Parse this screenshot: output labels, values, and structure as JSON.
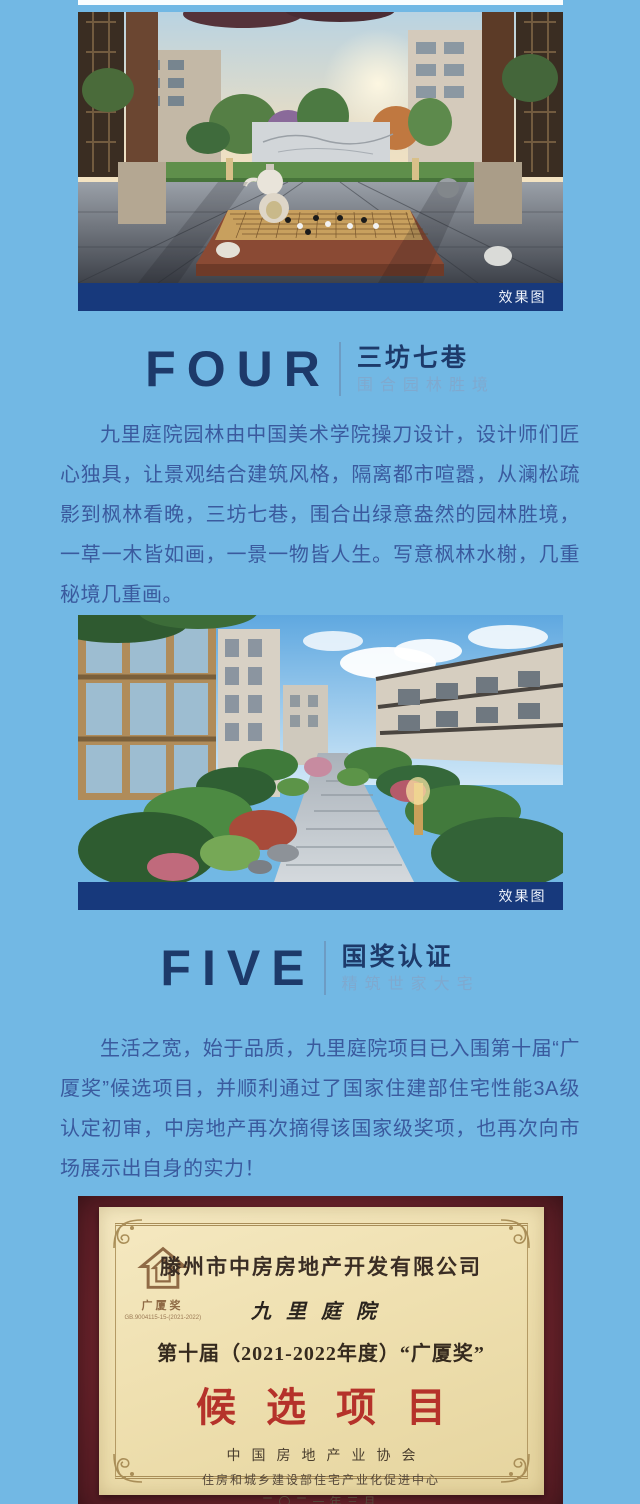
{
  "colors": {
    "background": "#72b8e4",
    "caption_bar": "#17397c",
    "heading_navy": "#1d3a6a",
    "paragraph_blue": "#3a5a9e",
    "subtitle_blue": "#7fa9cf",
    "award_red": "#b5322a",
    "bottom_strip": "#a6d4ed"
  },
  "hero_four": {
    "caption": "效果图"
  },
  "hero_five": {
    "caption": "效果图"
  },
  "section_four": {
    "number_label": "FOUR",
    "title": "三坊七巷",
    "subtitle": "围合园林胜境",
    "paragraph": "九里庭院园林由中国美术学院操刀设计，设计师们匠心独具，让景观结合建筑风格，隔离都市喧嚣，从澜松疏影到枫林看晚，三坊七巷，围合出绿意盎然的园林胜境，一草一木皆如画，一景一物皆人生。写意枫林水榭，几重秘境几重画。"
  },
  "section_five": {
    "number_label": "FIVE",
    "title": "国奖认证",
    "subtitle": "精筑世家大宅",
    "paragraph": "生活之宽，始于品质，九里庭院项目已入围第十届“广厦奖”候选项目，并顺利通过了国家住建部住宅性能3A级认定初审，中房地产再次摘得该国家级奖项，也再次向市场展示出自身的实力！"
  },
  "certificate": {
    "caption": "广厦奖候选项目",
    "logo_text": "广厦奖",
    "logo_serial": "GB.9004115-15-(2021-2022)",
    "company": "滕州市中房房地产开发有限公司",
    "project": "九里庭院",
    "award_line": "第十届（2021-2022年度）“广厦奖”",
    "award_title": "候选项目",
    "issuer_line1": "中国房地产业协会",
    "issuer_line2": "住房和城乡建设部住宅产业化促进中心",
    "date_line": "二〇二一年三月"
  }
}
